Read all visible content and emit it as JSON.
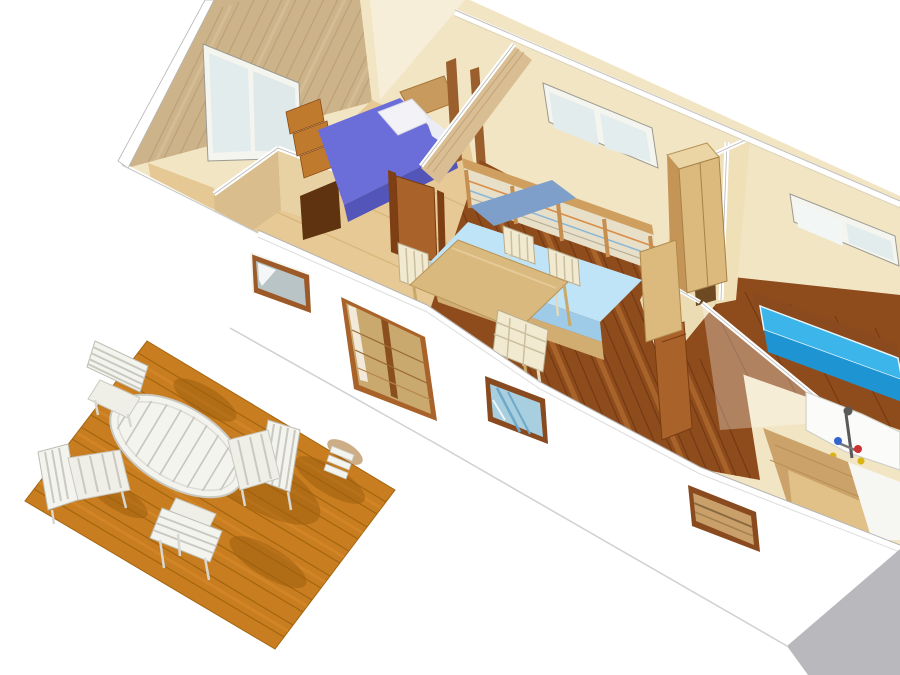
{
  "scene": {
    "kind": "3d-cutaway-floorplan-render",
    "description": "Isometric cutaway (dollhouse) rendering of a mobile-home interior with bedroom, living-dining room, second bedroom, bathroom and a front wooden deck with patio furniture",
    "width": 900,
    "height": 675,
    "objects": [
      "gable-wall",
      "gable-window",
      "bedroom-bed",
      "closet",
      "hallway-door",
      "sofa-daybed",
      "dining-table",
      "dining-chairs",
      "wardrobe-cabinet",
      "partition-walls",
      "double-bed",
      "bathroom-shower",
      "shower-mixer",
      "back-wall-windows",
      "front-wall",
      "sliding-glass-door",
      "front-windows",
      "wood-deck",
      "patio-table",
      "patio-chairs",
      "building-shadow"
    ]
  },
  "palette": {
    "background": "#ffffff",
    "wall_cream": "#f2e5c4",
    "wall_cream_dark": "#ecdcb4",
    "wall_cut_white": "#ffffff",
    "gable_wood": "#cdb38a",
    "gable_wood_grain": "#b3946a",
    "partition_wood": "#d9be93",
    "closet_wood_left": "#d9bd8c",
    "closet_wood_right": "#e8d2a4",
    "closet_dark": "#5f3310",
    "floor_dark": "#8e4c1c",
    "floor_dark_seam": "#6e3512",
    "floor_dark_light": "#c8823c",
    "floor_light": "#e6c994",
    "floor_light_seam": "#d2ab6a",
    "bed1_purple": "#6b6ed9",
    "bed1_side": "#5355b8",
    "pillow_white": "#f2f2f7",
    "headboard_wood": "#c89a5e",
    "bed2_top": "#3cb5ea",
    "bed2_front": "#1e95d2",
    "sofa_mattress": "#bfe3f7",
    "sofa_mattress_side": "#9ecbe8",
    "sofa_back_cushion": "#7d9fc9",
    "sofa_wood": "#d2ad72",
    "slat_panel": "#e8dfc8",
    "table_wood": "#d9b97e",
    "chair_cream": "#f1e9d0",
    "cabinet_front": "#dcb97c",
    "cabinet_side": "#c49556",
    "cabinet_top": "#ecd5a4",
    "door_wood": "#a9622a",
    "door_frame": "#7e3f14",
    "window_glass": "#e3ecec",
    "window_frame_white": "#f5f5f0",
    "window_frame_wood": "#9c5a28",
    "bath_window_glass": "#a8cfe0",
    "door_glass_wood": "#caa96e",
    "deck_wood": "#c87d20",
    "deck_seam": "#a4650f",
    "deck_shadow": "#9c5e0e",
    "outdoor_white": "#f4f4ef",
    "outdoor_white_shade": "#e4e4da",
    "ground_shadow": "#b9b9bd",
    "shower_white": "#fbfbf9",
    "bath_wood": "#cba36a",
    "bath_counter": "#e2c188",
    "knob_red": "#cc3333",
    "knob_blue": "#3366cc",
    "knob_yellow": "#d9b511",
    "fixture_gray": "#5a5a5a"
  }
}
